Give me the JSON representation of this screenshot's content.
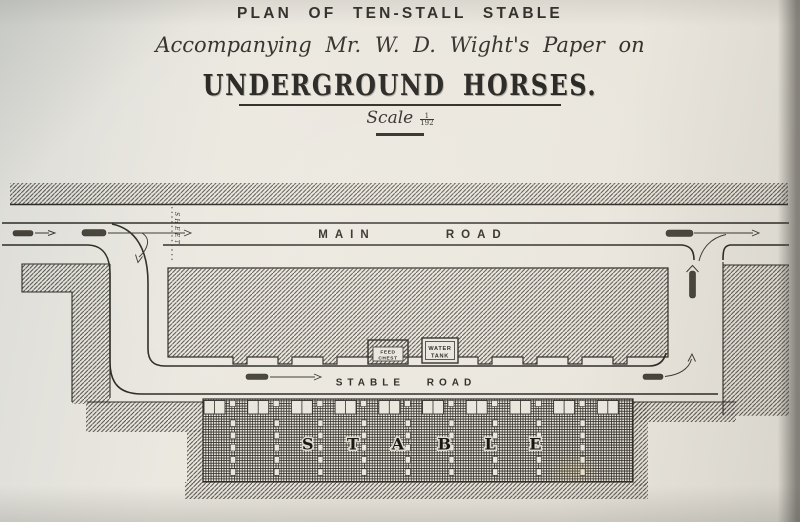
{
  "title": {
    "plan_line": "PLAN OF TEN-STALL STABLE",
    "subtitle": "Accompanying Mr. W. D. Wight's Paper on",
    "main_title": "UNDERGROUND HORSES.",
    "scale_word": "Scale",
    "scale_numerator": "1",
    "scale_denominator": "192"
  },
  "plan": {
    "main_road_label": "MAIN ROAD",
    "stable_road_label": "STABLE ROAD",
    "stable_label": "STABLE",
    "sheet_label": "SHEET",
    "feed_chest": {
      "line1": "FEED",
      "line2": "CHEST"
    },
    "water_tank": {
      "line1": "WATER",
      "line2": "TANK"
    },
    "stall_count": 10
  },
  "colors": {
    "paper": "#e9e6de",
    "ink": "#2d2b26",
    "hatch": "#4c4942"
  }
}
